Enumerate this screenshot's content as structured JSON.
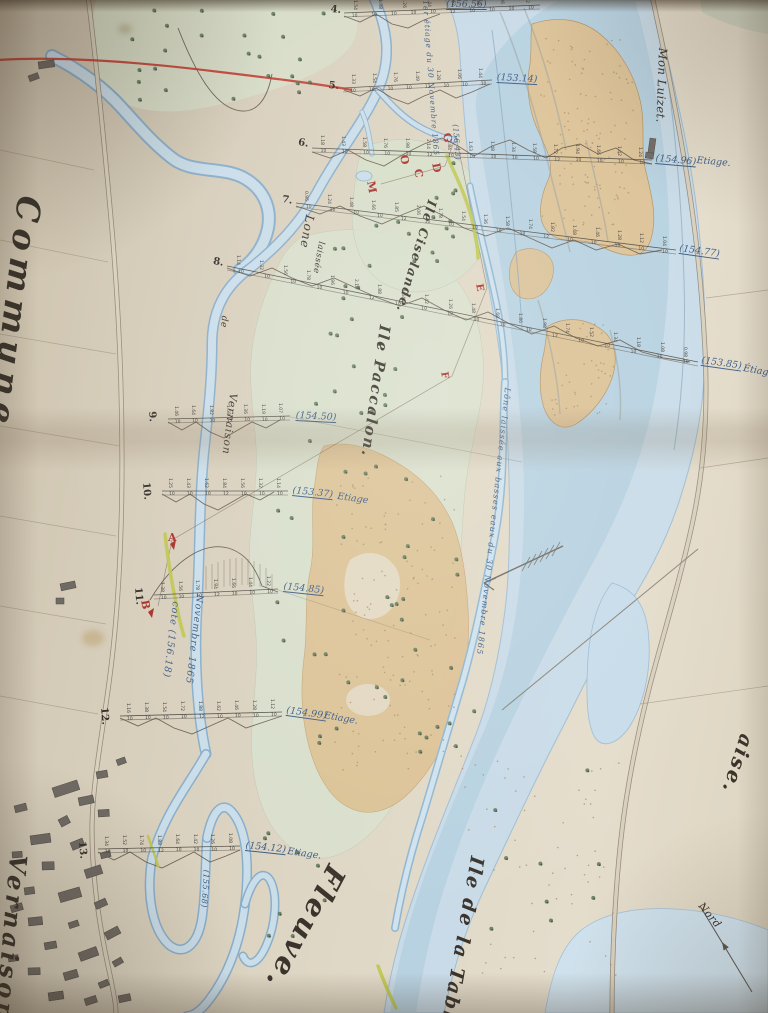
{
  "photo_subject": "Hand-drawn river survey map (photographed paper sheet with fold crease)",
  "colors": {
    "paper": "#d8cfbd",
    "water": "#c9dde9",
    "water_edge": "#8aaeca",
    "sand": "#dec294",
    "green_wash": "#d9e2cf",
    "red_accent": "#c23b30",
    "red_letter": "#a8322a",
    "ink_blue": "#3d5c85",
    "line_dark": "#4c473f",
    "tree_green": "#5e7457",
    "levee_yellow": "#bfc64e",
    "road_gray": "#8d8272",
    "building_gray": "#6f6a64",
    "pencil": "#8a8578"
  },
  "labels": [
    {
      "name": "commune-label",
      "text": "Commune",
      "x": 46,
      "y": 198,
      "rot": 97,
      "size": 33,
      "ls": 7,
      "cls": "cursive"
    },
    {
      "name": "vernaison-village-label",
      "text": "Vernaison",
      "x": 30,
      "y": 856,
      "rot": 95,
      "size": 24,
      "ls": 4,
      "cls": "cursive"
    },
    {
      "name": "fleuve-label",
      "text": "Fleuve.",
      "x": 350,
      "y": 874,
      "rot": 118,
      "size": 29,
      "ls": 3,
      "cls": "cursive"
    },
    {
      "name": "ile-de-la-table-label",
      "text": "Ile de la Table",
      "x": 486,
      "y": 858,
      "rot": 100,
      "size": 19,
      "ls": 2,
      "cls": "cursive"
    },
    {
      "name": "ile-paccalon-label",
      "text": "Ile Paccalon.",
      "x": 392,
      "y": 326,
      "rot": 98,
      "size": 15,
      "ls": 2,
      "cls": "cursive"
    },
    {
      "name": "ile-ciselande-label",
      "text": "Ile Ciselande.",
      "x": 438,
      "y": 202,
      "rot": 106,
      "size": 12.5,
      "ls": 1.5,
      "cls": "cursive"
    },
    {
      "name": "mon-luizet-label",
      "text": "Mon Luizet.",
      "x": 668,
      "y": 48,
      "rot": 92,
      "size": 11.5,
      "ls": 0.5,
      "cls": ""
    },
    {
      "name": "commune-partial-right-label",
      "text": "aise.",
      "x": 757,
      "y": 738,
      "rot": 108,
      "size": 20,
      "ls": 2,
      "cls": "cursive"
    },
    {
      "name": "nord-label",
      "text": "Nord",
      "x": 704,
      "y": 901,
      "rot": 50,
      "size": 10.5,
      "ls": 0.5,
      "cls": ""
    },
    {
      "name": "lone-label",
      "text": "Lone",
      "x": 316,
      "y": 216,
      "rot": 100,
      "size": 12,
      "ls": 1,
      "cls": ""
    },
    {
      "name": "lone-laissee-label",
      "text": "laissée",
      "x": 325,
      "y": 242,
      "rot": 100,
      "size": 8.5,
      "ls": 0.5,
      "cls": ""
    },
    {
      "name": "lone-de-label",
      "text": "de",
      "x": 228,
      "y": 316,
      "rot": 95,
      "size": 9,
      "ls": 0.5,
      "cls": ""
    },
    {
      "name": "lone-vernaison-label",
      "text": "Vernaison",
      "x": 238,
      "y": 394,
      "rot": 97,
      "size": 10.5,
      "ls": 1,
      "cls": ""
    },
    {
      "name": "etiage-top-annotation",
      "text": "1er étiage du 30 Novembre 1865",
      "x": 429,
      "y": 0,
      "rot": 86,
      "size": 7.5,
      "ls": 1,
      "cls": "ink"
    },
    {
      "name": "lone-channel-annotation",
      "text": "Lône laissée aux basses eaux du 30 Novembre 1865",
      "x": 511,
      "y": 388,
      "rot": 96,
      "size": 8,
      "ls": 1.2,
      "cls": "ink"
    },
    {
      "name": "cote-annotation",
      "text": "cote (156.18)",
      "x": 180,
      "y": 602,
      "rot": 97,
      "size": 9.5,
      "ls": 1,
      "cls": "ink"
    },
    {
      "name": "novembre-annotation",
      "text": "Novembre 1865",
      "x": 204,
      "y": 595,
      "rot": 97,
      "size": 9.5,
      "ls": 1,
      "cls": "ink"
    },
    {
      "name": "point-g-elevation",
      "text": "(156.43)",
      "x": 459,
      "y": 124,
      "rot": 86,
      "size": 7.5,
      "ls": 0.5,
      "cls": "ink"
    },
    {
      "name": "section13-vertical-elevation",
      "text": "(155.68)",
      "x": 210,
      "y": 870,
      "rot": 94,
      "size": 8,
      "ls": 0.5,
      "cls": "ink"
    }
  ],
  "sections": [
    {
      "num": "4.",
      "num_x": 331,
      "num_y": 5,
      "num_rot": 5,
      "x1": 344,
      "y1": 13,
      "x2": 540,
      "y2": 5,
      "elev": "(156.56)",
      "elev_x": 446,
      "elev_y": 0,
      "elev_rot": 0,
      "etiage": "",
      "etiage_x": 0,
      "etiage_y": 0,
      "etiage_rot": 0,
      "depths": "1.54 1.38 1.26 1.44 1.62 1.48 1.36 1.52",
      "spacing": "10 10 10 10 10 12 10 10 10 10"
    },
    {
      "num": "5.",
      "num_x": 329,
      "num_y": 81,
      "num_rot": 5,
      "x1": 343,
      "y1": 88,
      "x2": 492,
      "y2": 80,
      "elev": "(153.14)",
      "elev_x": 497,
      "elev_y": 73,
      "elev_rot": 3,
      "etiage": "",
      "etiage_x": 0,
      "etiage_y": 0,
      "etiage_rot": 0,
      "depths": "1.33 1.54 1.76 1.49 1.28 1.06 1.44",
      "spacing": "10 10 10 10 12 10 10 10"
    },
    {
      "num": "6.",
      "num_x": 299,
      "num_y": 138,
      "num_rot": 10,
      "x1": 312,
      "y1": 148,
      "x2": 652,
      "y2": 160,
      "elev": "(154.96)",
      "elev_x": 656,
      "elev_y": 154,
      "elev_rot": 5,
      "etiage": "Etiage.",
      "etiage_x": 697,
      "etiage_y": 156,
      "etiage_rot": 5,
      "depths": "1.18 1.43 1.58 1.76 1.98 2.14 1.84 1.63 1.48 1.34 1.58 1.72 1.94 1.66 1.42 1.24",
      "spacing": "10 10 10 10 10 12 10 10 10 10 10 12 10 10 10 10"
    },
    {
      "num": "7.",
      "num_x": 283,
      "num_y": 195,
      "num_rot": 10,
      "x1": 296,
      "y1": 203,
      "x2": 676,
      "y2": 250,
      "elev": "(154.77)",
      "elev_x": 680,
      "elev_y": 244,
      "elev_rot": 8,
      "etiage": "",
      "etiage_x": 0,
      "etiage_y": 0,
      "etiage_rot": 0,
      "depths": "0.96 1.24 1.48 1.66 1.85 2.06 1.78 1.54 1.36 1.58 1.74 1.92 1.68 1.46 1.28 1.12 1.04",
      "spacing": "10 10 10 10 12 10 10 10 10 10 12 10 10 10 10 10"
    },
    {
      "num": "8.",
      "num_x": 214,
      "num_y": 257,
      "num_rot": 10,
      "x1": 227,
      "y1": 266,
      "x2": 698,
      "y2": 362,
      "elev": "(153.85)",
      "elev_x": 702,
      "elev_y": 356,
      "elev_rot": 8,
      "etiage": "Étiage",
      "etiage_x": 744,
      "etiage_y": 364,
      "etiage_rot": 10,
      "depths": "1.14 1.32 1.56 1.78 1.96 2.18 1.88 1.64 1.42 1.26 1.48 1.68 1.86 1.98 1.74 1.52 1.34 1.18 1.08 0.98",
      "spacing": "10 10 10 10 10 12 10 10 10 10 10 10 12 10 10 10 10 10"
    },
    {
      "num": "9.",
      "num_x": 156,
      "num_y": 411,
      "num_rot": 85,
      "x1": 168,
      "y1": 419,
      "x2": 290,
      "y2": 416,
      "elev": "(154.50)",
      "elev_x": 296,
      "elev_y": 411,
      "elev_rot": 3,
      "etiage": "",
      "etiage_x": 0,
      "etiage_y": 0,
      "etiage_rot": 0,
      "depths": "1.46 1.64 1.82 1.58 1.36 1.19 1.07",
      "spacing": "10 10 10 12 10 10 10"
    },
    {
      "num": "10.",
      "num_x": 150,
      "num_y": 482,
      "num_rot": 85,
      "x1": 162,
      "y1": 491,
      "x2": 288,
      "y2": 491,
      "elev": "(153.37)",
      "elev_x": 293,
      "elev_y": 486,
      "elev_rot": 6,
      "etiage": "Etiage",
      "etiage_x": 338,
      "etiage_y": 492,
      "etiage_rot": 8,
      "depths": "1.25 1.43 1.62 1.84 1.56 1.32 1.14",
      "spacing": "10 10 10 12 10 10 10"
    },
    {
      "num": "11.",
      "num_x": 142,
      "num_y": 587,
      "num_rot": 85,
      "x1": 154,
      "y1": 595,
      "x2": 278,
      "y2": 589,
      "elev": "(154.85)",
      "elev_x": 284,
      "elev_y": 582,
      "elev_rot": 6,
      "etiage": "",
      "etiage_x": 0,
      "etiage_y": 0,
      "etiage_rot": 0,
      "depths": "1.38 1.56 1.78 1.94 1.66 1.44 1.22",
      "spacing": "10 10 10 12 10 10 10"
    },
    {
      "num": "12.",
      "num_x": 108,
      "num_y": 707,
      "num_rot": 85,
      "x1": 120,
      "y1": 716,
      "x2": 282,
      "y2": 712,
      "elev": "(154.99)",
      "elev_x": 287,
      "elev_y": 706,
      "elev_rot": 8,
      "etiage": "Etiage.",
      "etiage_x": 325,
      "etiage_y": 711,
      "etiage_rot": 10,
      "depths": "1.16 1.38 1.54 1.72 1.88 1.62 1.46 1.28 1.12",
      "spacing": "10 10 10 10 12 10 10 10 10"
    },
    {
      "num": "13.",
      "num_x": 86,
      "num_y": 841,
      "num_rot": 85,
      "x1": 98,
      "y1": 849,
      "x2": 240,
      "y2": 846,
      "elev": "(154.12)",
      "elev_x": 246,
      "elev_y": 841,
      "elev_rot": 6,
      "etiage": "Etiage.",
      "etiage_x": 288,
      "etiage_y": 847,
      "etiage_rot": 8,
      "depths": "1.34 1.52 1.74 1.88 1.64 1.42 1.26 1.08",
      "spacing": "10 10 10 12 10 10 10 10"
    }
  ],
  "letters": [
    {
      "char": "G",
      "x": 452,
      "y": 132,
      "rot": 80,
      "size": 11
    },
    {
      "char": "O",
      "x": 409,
      "y": 154,
      "rot": 80,
      "size": 11
    },
    {
      "char": "D",
      "x": 441,
      "y": 162,
      "rot": 80,
      "size": 11
    },
    {
      "char": "C",
      "x": 423,
      "y": 168,
      "rot": 80,
      "size": 11
    },
    {
      "char": "M",
      "x": 376,
      "y": 180,
      "rot": 80,
      "size": 11
    },
    {
      "char": "E",
      "x": 483,
      "y": 283,
      "rot": 80,
      "size": 10
    },
    {
      "char": "F",
      "x": 448,
      "y": 371,
      "rot": 80,
      "size": 10
    },
    {
      "char": "A",
      "x": 168,
      "y": 532,
      "rot": 0,
      "size": 11
    },
    {
      "char": "B",
      "x": 150,
      "y": 599,
      "rot": 80,
      "size": 11
    }
  ]
}
